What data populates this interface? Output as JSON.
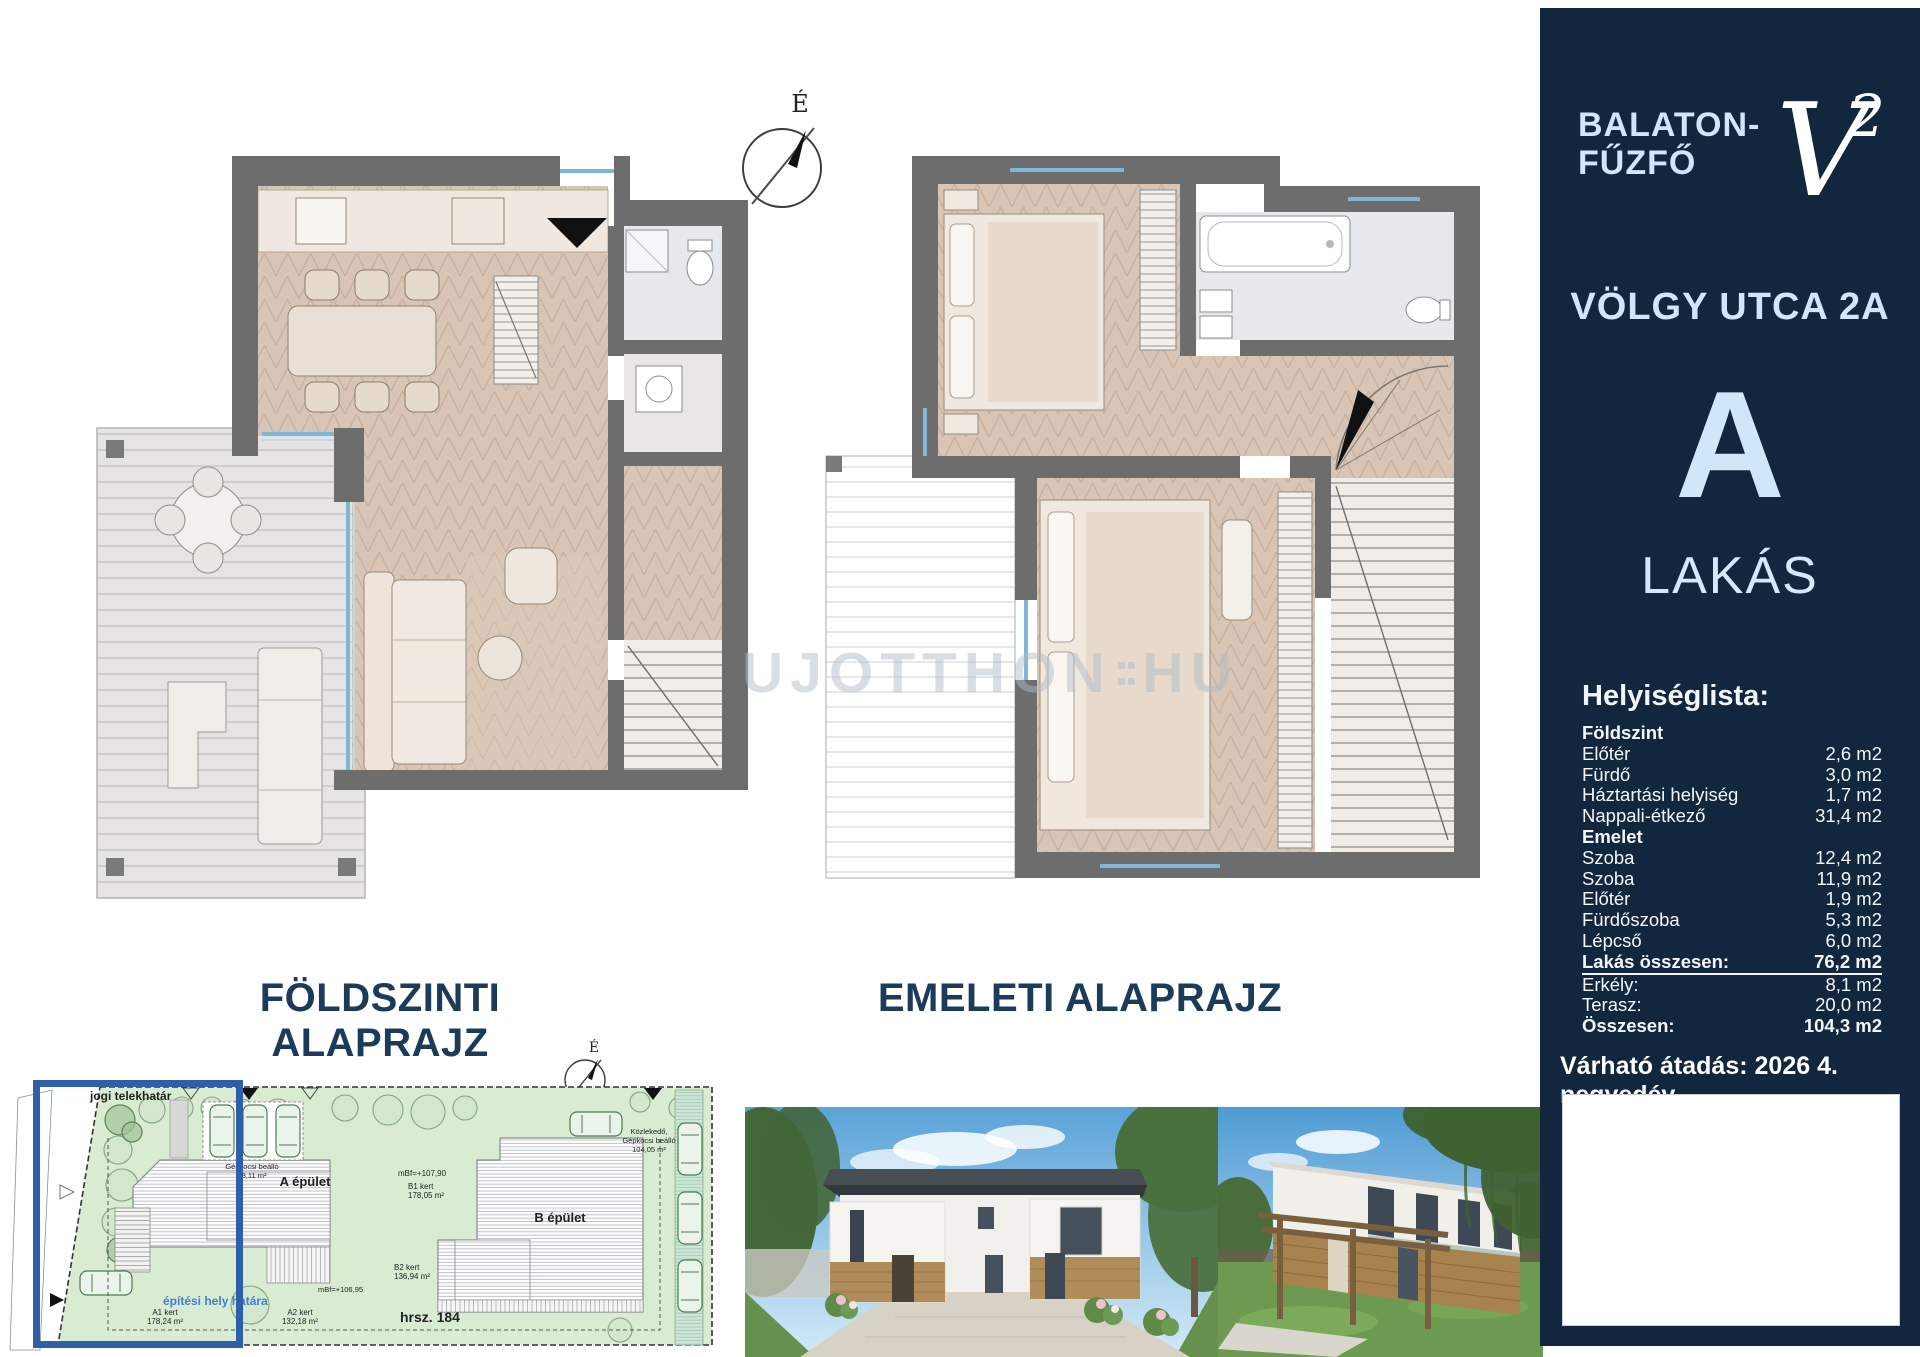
{
  "sidebar": {
    "location_line1": "BALATON-",
    "location_line2": "FŰZFŐ",
    "logo_letter": "V",
    "logo_sup": "2",
    "street": "VÖLGY UTCA 2A",
    "unit_letter": "A",
    "unit_type": "LAKÁS",
    "room_list": {
      "title": "Helyiséglista:",
      "rows": [
        {
          "label": "Földszint",
          "value": ""
        },
        {
          "label": "Előtér",
          "value": "2,6 m2"
        },
        {
          "label": "Fürdő",
          "value": "3,0 m2"
        },
        {
          "label": "Háztartási helyiség",
          "value": "1,7 m2"
        },
        {
          "label": "Nappali-étkező",
          "value": "31,4 m2"
        },
        {
          "label": "Emelet",
          "value": ""
        },
        {
          "label": "Szoba",
          "value": "12,4 m2"
        },
        {
          "label": "Szoba",
          "value": "11,9 m2"
        },
        {
          "label": "Előtér",
          "value": "1,9 m2"
        },
        {
          "label": "Fürdőszoba",
          "value": "5,3 m2"
        },
        {
          "label": "Lépcső",
          "value": "6,0 m2"
        },
        {
          "label": "Lakás összesen:",
          "value": "76,2 m2"
        },
        {
          "label": "Erkély:",
          "value": "8,1 m2"
        },
        {
          "label": "Terasz:",
          "value": "20,0 m2"
        },
        {
          "label": "Összesen:",
          "value": "104,3 m2"
        }
      ]
    },
    "handover": "Várható átadás: 2026 4. negyedév"
  },
  "plans": {
    "ground_label": "FÖLDSZINTI ALAPRAJZ",
    "upper_label": "EMELETI ALAPRAJZ",
    "compass_letter": "É"
  },
  "watermark": {
    "part1": "UJOTTHON",
    "part2": "HU"
  },
  "siteplan": {
    "boundary_label": "jogi telekhatár",
    "building_a": "A épület",
    "building_b": "B épület",
    "carport_a_line1": "Gépkocsi beálló",
    "carport_a_line2": "48,11 m²",
    "carport_b_line1": "Közlekedő,",
    "carport_b_line2": "Gépkocsi beálló",
    "carport_b_line3": "104,05 m²",
    "level_a": "mBf=+106,95",
    "level_b": "mBf=+107,90",
    "garden_a1_line1": "A1 kert",
    "garden_a1_line2": "178,24 m²",
    "garden_a2_line1": "A2 kert",
    "garden_a2_line2": "132,18 m²",
    "garden_b1_line1": "B1 kert",
    "garden_b1_line2": "178,05 m²",
    "garden_b2_line1": "B2 kert",
    "garden_b2_line2": "136,94 m²",
    "building_limit_label": "építési hely határa",
    "parcel_number": "hrsz. 184"
  },
  "colors": {
    "navy": "#12263e",
    "light_blue": "#cfe7f8",
    "label_navy": "#1c3a5a",
    "wall_gray": "#6e6d6d",
    "floor_beige": "#d8c5b6",
    "site_green": "#d9ecd2",
    "highlight_blue": "#2e5fa8",
    "glazing_blue": "#7fb8d4"
  }
}
